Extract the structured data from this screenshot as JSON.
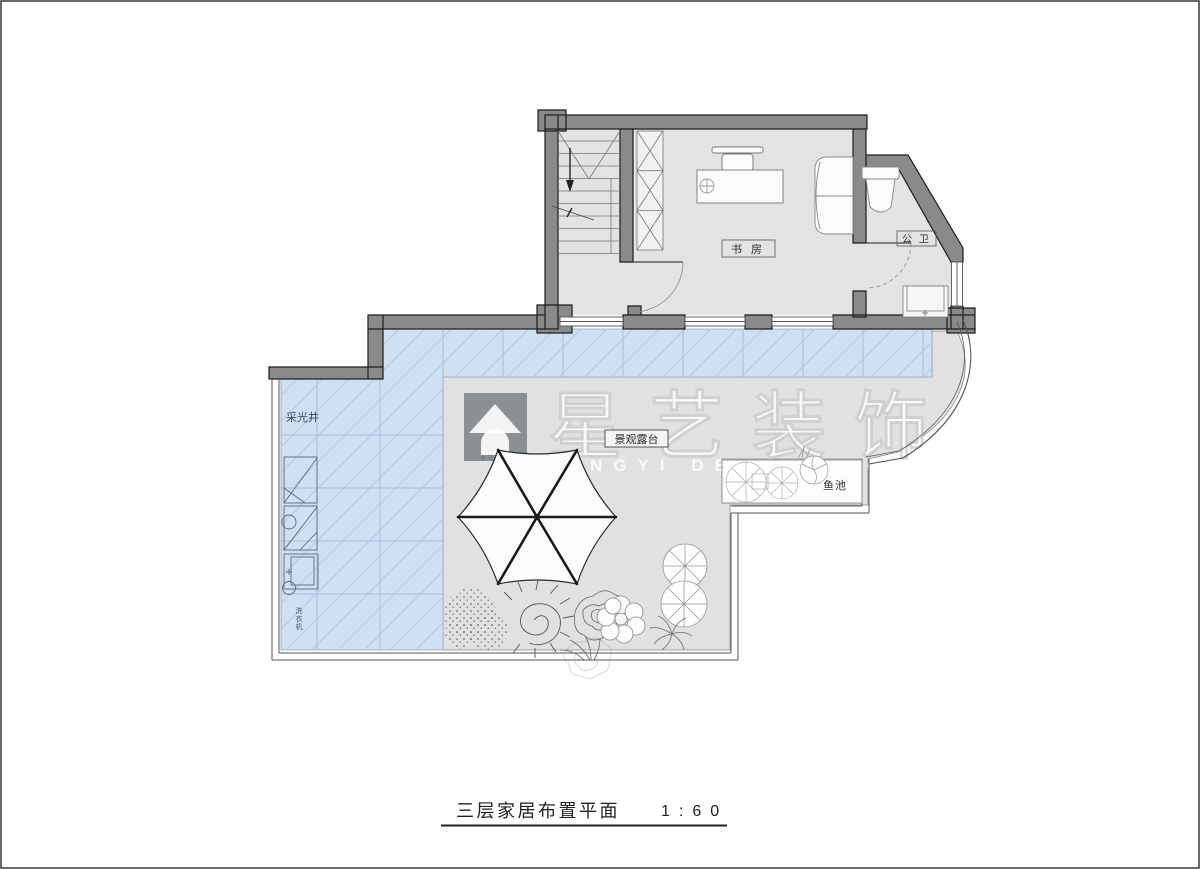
{
  "drawing": {
    "title": "三层家居布置平面",
    "scale": "1:60",
    "labels": {
      "study": "书 房",
      "bathroom": "公 卫",
      "skylight_well": "采光井",
      "terrace": "景观露台",
      "fish_pond": "鱼池",
      "utility": "洗衣机"
    },
    "watermark": {
      "brand": "星艺装饰",
      "tagline": "XINGYI DECORATION"
    },
    "colors": {
      "wall": "#8a8a8a",
      "wall_edge": "#1c1c1c",
      "floor": "#e3e3e3",
      "terrace_floor": "#e1e1e1",
      "glass": "#cfe0f3",
      "glass_hatch": "#b4c8e4",
      "line": "#666666",
      "text": "#2e2e2e"
    }
  }
}
